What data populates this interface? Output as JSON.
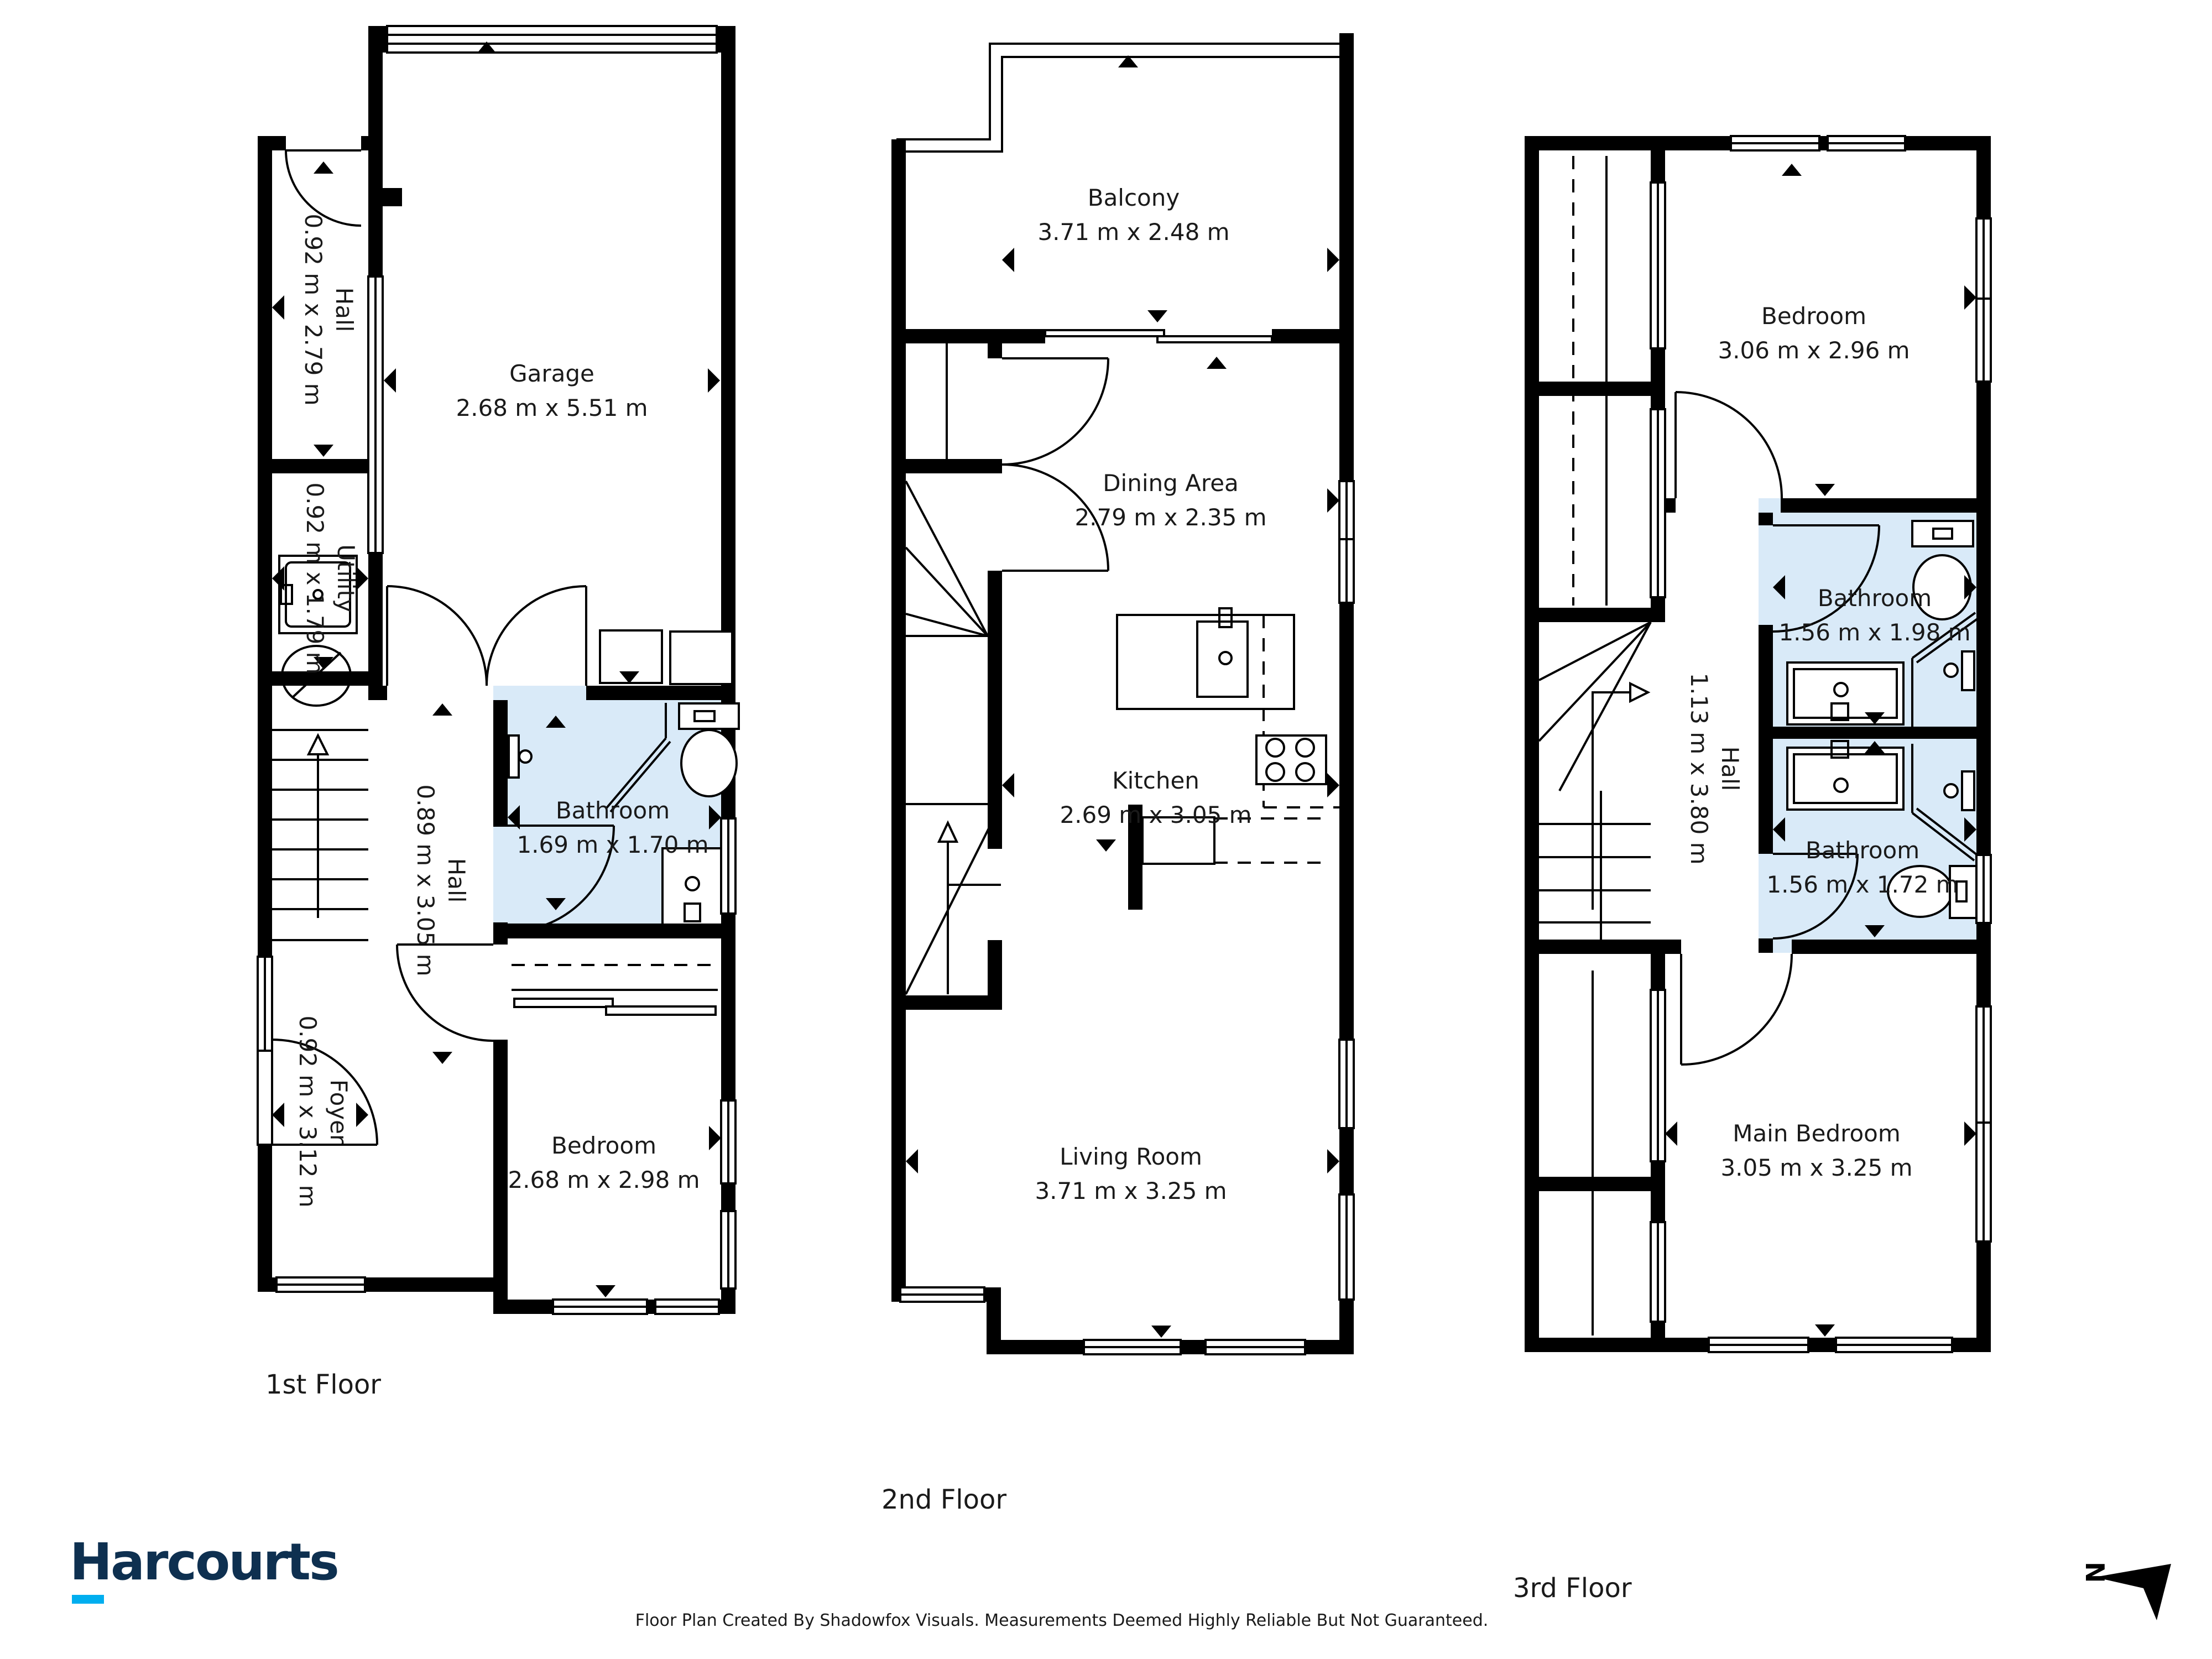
{
  "floors": [
    {
      "label": "1st Floor",
      "rooms": [
        {
          "name": "Hall",
          "dims": "0.92 m x 2.79 m"
        },
        {
          "name": "Garage",
          "dims": "2.68 m x 5.51 m"
        },
        {
          "name": "Utility",
          "dims": "0.92 m x 1.79 m"
        },
        {
          "name": "Bathroom",
          "dims": "1.69 m x 1.70 m"
        },
        {
          "name": "Hall",
          "dims": "0.89 m x 3.05 m"
        },
        {
          "name": "Foyer",
          "dims": "0.92 m x 3.12 m"
        },
        {
          "name": "Bedroom",
          "dims": "2.68 m x 2.98 m"
        }
      ]
    },
    {
      "label": "2nd Floor",
      "rooms": [
        {
          "name": "Balcony",
          "dims": "3.71 m x 2.48 m"
        },
        {
          "name": "Dining Area",
          "dims": "2.79 m x 2.35 m"
        },
        {
          "name": "Kitchen",
          "dims": "2.69 m x 3.05 m"
        },
        {
          "name": "Living Room",
          "dims": "3.71 m x 3.25 m"
        }
      ]
    },
    {
      "label": "3rd Floor",
      "rooms": [
        {
          "name": "Bedroom",
          "dims": "3.06 m x 2.96 m"
        },
        {
          "name": "Bathroom",
          "dims": "1.56 m x 1.98 m"
        },
        {
          "name": "Hall",
          "dims": "1.13 m x 3.80 m"
        },
        {
          "name": "Bathroom",
          "dims": "1.56 m x 1.72 m"
        },
        {
          "name": "Main Bedroom",
          "dims": "3.05 m x 3.25 m"
        }
      ]
    }
  ],
  "branding": {
    "logo_text": "Harcourts"
  },
  "footer": {
    "disclaimer": "Floor Plan Created By Shadowfox Visuals. Measurements Deemed Highly Reliable But Not Guaranteed."
  },
  "compass": {
    "north_label": "N"
  },
  "colors": {
    "wall": "#000000",
    "bathroom_fill": "#d9eaf8",
    "logo_navy": "#0e3050",
    "logo_cyan": "#00aeef"
  }
}
